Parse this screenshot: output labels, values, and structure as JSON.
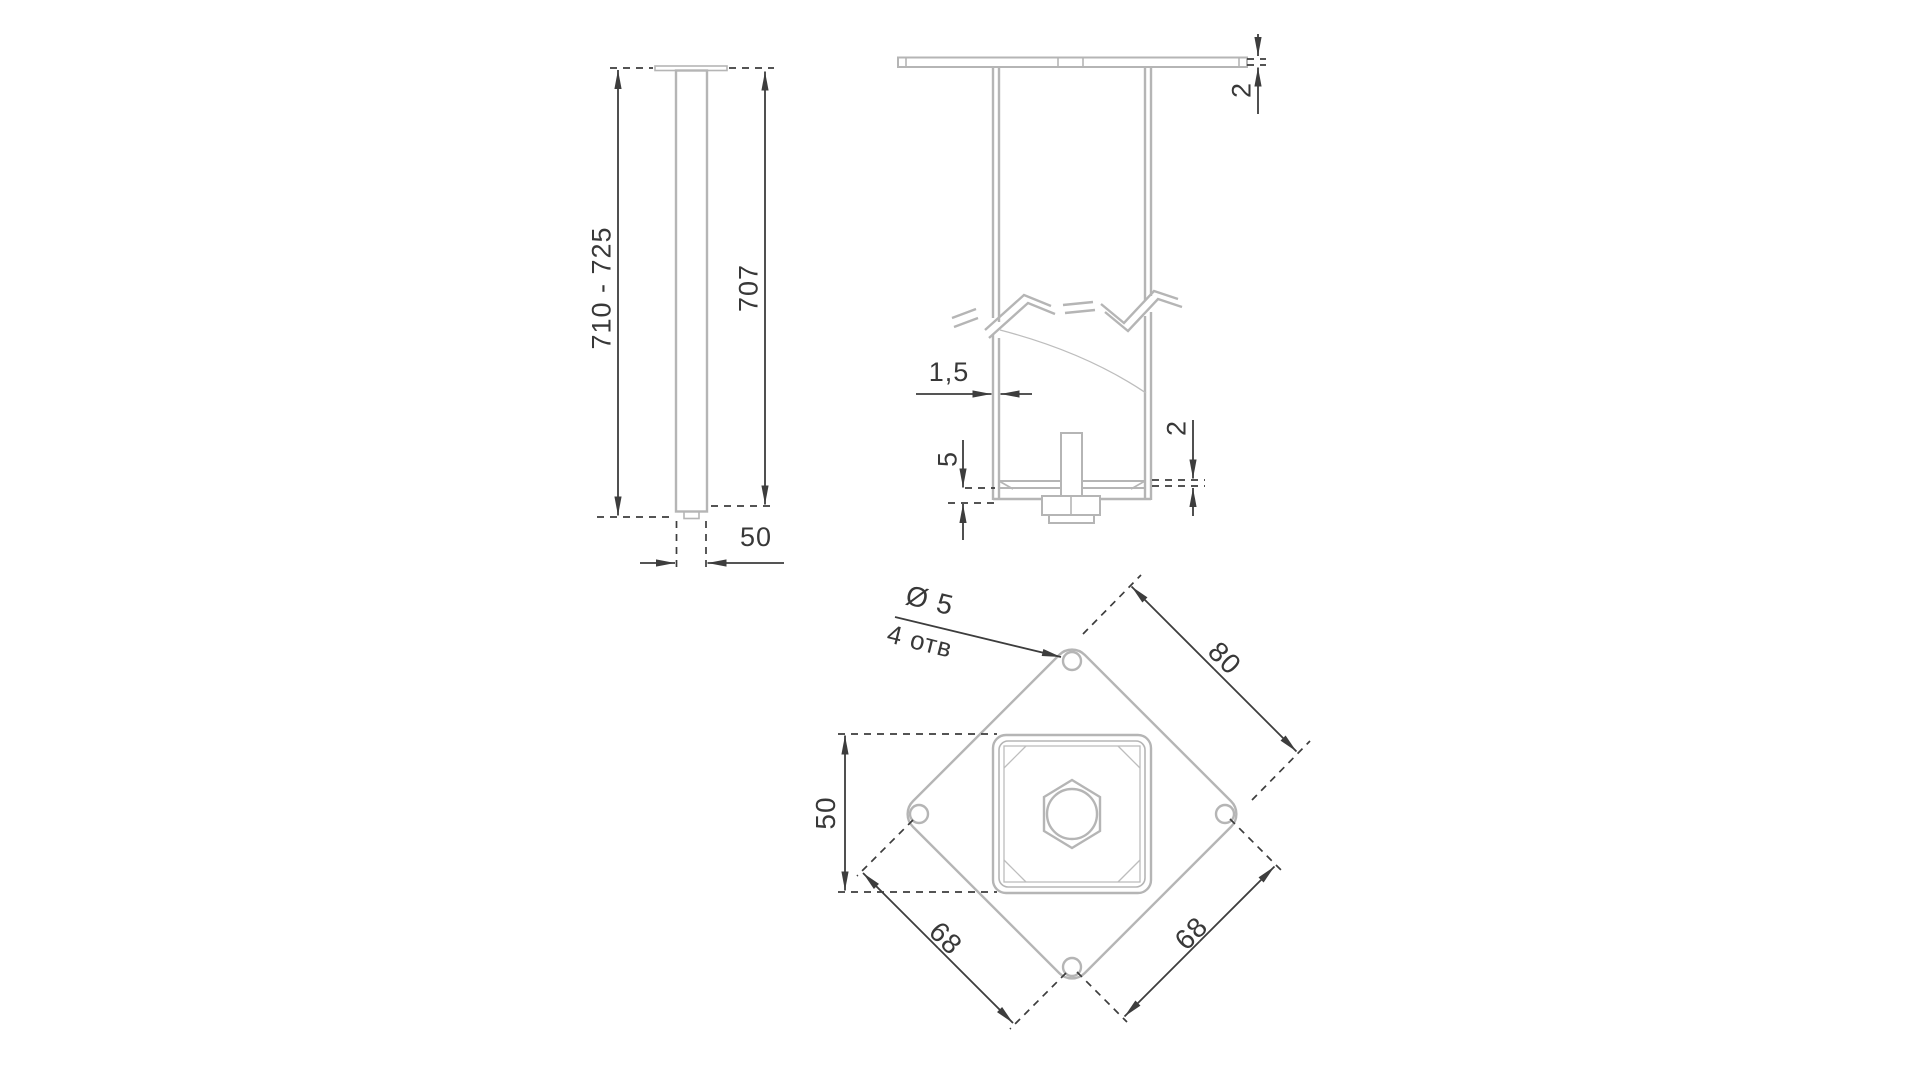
{
  "drawing": {
    "type": "technical-drawing",
    "language": "ru",
    "colors": {
      "part_line": "#b5b5b5",
      "dimension_line": "#3d3d3d",
      "background": "#ffffff"
    }
  },
  "views": {
    "side": {
      "dims": {
        "overall_height": "710 - 725",
        "tube_length": "707",
        "tube_width": "50"
      }
    },
    "section": {
      "dims": {
        "top_plate_thickness": "2",
        "wall_thickness": "1,5",
        "foot_plate_gap": "5",
        "foot_plate_thickness": "2"
      }
    },
    "bottom": {
      "dims": {
        "hole_diameter": "Ø 5",
        "hole_count": "4 отв",
        "plate_edge": "80",
        "tube_size": "50",
        "hole_spacing_left": "68",
        "hole_spacing_right": "68"
      }
    }
  }
}
